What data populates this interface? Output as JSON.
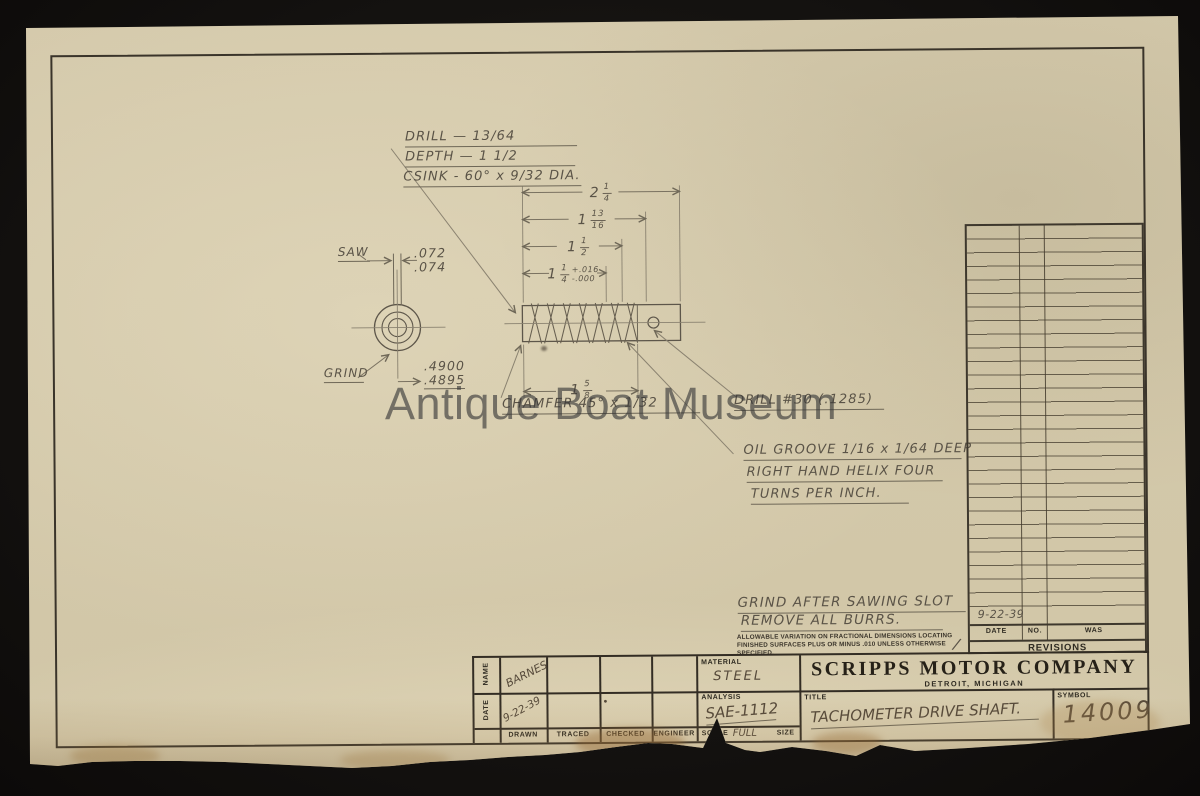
{
  "watermark": "Antique Boat Museum",
  "colors": {
    "paper": "#d5caac",
    "background": "#141210",
    "pencil": "#6e6757",
    "ink": "#2e2a21"
  },
  "callouts": {
    "drill_line1": "DRILL — 13/64",
    "drill_line2": "DEPTH — 1 1/2",
    "drill_line3": "CSINK - 60° x 9/32 DIA.",
    "saw_label": "SAW",
    "saw_upper": ".072",
    "saw_lower": ".074",
    "grind_label": "GRIND",
    "grind_upper": ".4900",
    "grind_lower": ".4895",
    "chamfer": "CHAMFER 45° x 1/32",
    "drill_hole": "DRILL #30 (.1285)",
    "oil_groove_line1": "OIL GROOVE  1/16 x 1/64 DEEP",
    "oil_groove_line2": "RIGHT HAND HELIX FOUR",
    "oil_groove_line3": "TURNS PER INCH.",
    "grind_after_line1": "GRIND AFTER SAWING SLOT",
    "grind_after_line2": "REMOVE ALL BURRS."
  },
  "dimensions": {
    "overall": {
      "whole": "2",
      "num": "1",
      "den": "4"
    },
    "second": {
      "whole": "1",
      "num": "13",
      "den": "16"
    },
    "third": {
      "whole": "1",
      "num": "1",
      "den": "2"
    },
    "fourth": {
      "whole": "1",
      "num": "1",
      "den": "4",
      "tol_plus": "+.016",
      "tol_minus": "-.000"
    },
    "thread_length": {
      "whole": "1",
      "num": "5",
      "den": "8"
    }
  },
  "tolerance_note": {
    "line1": "ALLOWABLE VARIATION ON FRACTIONAL DIMENSIONS LOCATING",
    "line2": "FINISHED SURFACES PLUS OR MINUS .010 UNLESS OTHERWISE",
    "line3": "SPECIFIED.",
    "tick": "/"
  },
  "revisions": {
    "title": "REVISIONS",
    "columns": {
      "date": "DATE",
      "no": "NO.",
      "was": "WAS"
    },
    "entry_date": "9-22-39"
  },
  "title_block": {
    "company": "SCRIPPS MOTOR COMPANY",
    "location": "DETROIT, MICHIGAN",
    "labels": {
      "name": "NAME",
      "date": "DATE",
      "drawn": "DRAWN",
      "traced": "TRACED",
      "checked": "CHECKED",
      "engineer": "ENGINEER",
      "material": "MATERIAL",
      "analysis": "ANALYSIS",
      "scale": "SCALE",
      "size": "SIZE",
      "title": "TITLE",
      "symbol": "SYMBOL"
    },
    "values": {
      "drawn_name": "BARNES",
      "drawn_date": "9-22-39",
      "checked_mark": "•",
      "material": "STEEL",
      "analysis": "SAE-1112",
      "scale": "FULL",
      "title": "TACHOMETER DRIVE SHAFT.",
      "symbol": "14009"
    }
  }
}
